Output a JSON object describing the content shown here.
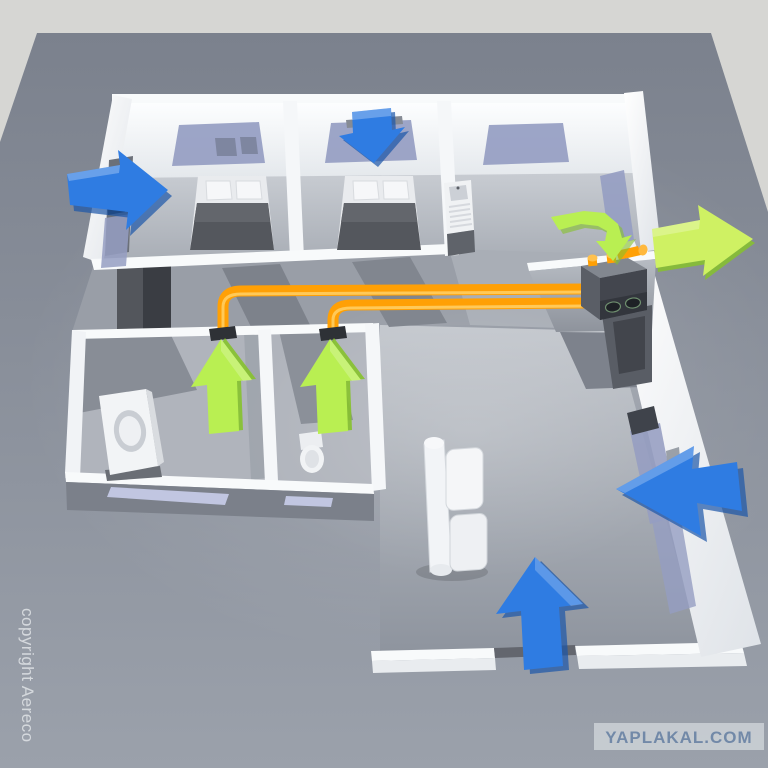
{
  "watermarks": {
    "copyright": "copyright Aereco",
    "badge": "YAPLAKAL.COM"
  },
  "colors": {
    "background": "#d6d6d3",
    "ground": "#8a9099",
    "wall": "#f8fafb",
    "floor": "#b4b8c0",
    "supply_arrow": "#2f7ce2",
    "supply_arrow_shade": "#1b55a8",
    "exhaust_arrow": "#b9ef52",
    "exhaust_arrow_shade": "#86c22c",
    "exit_arrow": "#cff163",
    "duct": "#ffa005",
    "duct_highlight": "#ffd067",
    "unit_body": "#43464e",
    "glass": "#959dc2",
    "badge_bg": "#cbd0d5",
    "badge_text": "#7289a8",
    "copyright_text": "#e5e8eb"
  },
  "scene": {
    "type": "3d-apartment-ventilation-diagram",
    "supply_arrow_count": 4,
    "exhaust_arrow_count": 4,
    "duct_count": 2
  }
}
